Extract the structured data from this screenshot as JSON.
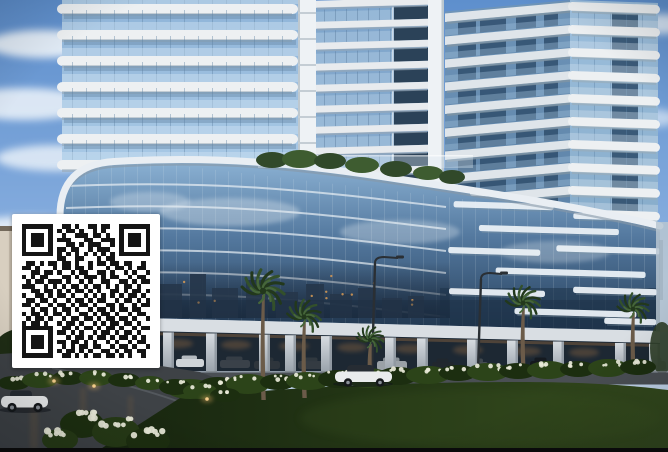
{
  "colors": {
    "sky_top": "#5e8fcd",
    "sky_mid": "#83abdd",
    "sky_low": "#c6d8ec",
    "cloud": "#eef4fa",
    "glass_light": "#a9c9e6",
    "glass_light2": "#8fb4d8",
    "glass_mid": "#7fa6cc",
    "glass_deep": "#2b4258",
    "slab_white": "#edf0f2",
    "slab_shade": "#dfe5ea",
    "slab_shadow": "#9aabb8",
    "pillar_strip": "#eef2f5",
    "podium_top": "#8cb2d4",
    "podium_mid": "#54799f",
    "podium_deep": "#27405c",
    "bar_white": "#eaf0f5",
    "parapet": "#e9eef3",
    "parapet_shadow": "#8798a6",
    "city": "#26364a",
    "warm": "#d79a55",
    "fascia": "#d9dee3",
    "pillar_top": "#d6dbe0",
    "pillar_bot": "#99a2ab",
    "opening": "#1d2833",
    "warm_glow": "#c08348",
    "road": "#3e4246",
    "road_front": "#4a4f54",
    "curb": "#7b8187",
    "lawn_dark": "#17250f",
    "lawn_mid": "#253816",
    "lawn_light": "#33491d",
    "shrub": "#2c4419",
    "shrub_dark": "#1c2e10",
    "flower": "#e9ead9",
    "frond": "#33502b",
    "frond_dark": "#22381c",
    "trunk": "#6b5b49",
    "lamp": "#2a2f34",
    "haze": "#b7c5d1",
    "beige": "#d8cfc0",
    "beige_dark": "#746a5c",
    "tree_dark": "#1f2d15",
    "car_white": "#e9ebec",
    "car_silver": "#a9b0b6",
    "window_dark": "#262c33",
    "qr_bg": "#ffffff",
    "qr_fg": "#141414",
    "bar": "#0a0a0b"
  },
  "qr": {
    "position": {
      "x": 12,
      "y": 214,
      "width": 148,
      "height": 154
    },
    "modules": 29,
    "matrix": [
      "11111110011010011011001111111",
      "10000010101101001010001000001",
      "10111010010011101101001011101",
      "10111010111000110011101011101",
      "10111010001101011100101011101",
      "10000010110110010111001000001",
      "11111110101010101010101111111",
      "00000000110011000101100000000",
      "01101011011010010110110110010",
      "11010001011011010001011010110",
      "00110110100101100110100101001",
      "10101100011010111010110010110",
      "01011011101001010011001101011",
      "11100101010110101101010110100",
      "00110110101011010100110101101",
      "10011010110100101010101011010",
      "01101101001011010110010110101",
      "11010010110101101001101001011",
      "00101101011010010110101101100",
      "10110101101001101011010010110",
      "01011010010110110101101101001",
      "10110100101101001010110110100",
      "11111110011010110101101001011",
      "10000010110101001011010110100",
      "10111010001011010110101101010",
      "10111010110110101001010010110",
      "10111010010101101100101101001",
      "10000010101101010011010110110",
      "11111110011010101101101010010"
    ]
  },
  "scene": {
    "clouds": [
      [
        42,
        44,
        55,
        14,
        0.9
      ],
      [
        24,
        104,
        70,
        16,
        0.85
      ],
      [
        56,
        158,
        60,
        13,
        0.8
      ],
      [
        30,
        233,
        75,
        17,
        0.85
      ],
      [
        52,
        298,
        55,
        13,
        0.75
      ],
      [
        26,
        344,
        65,
        14,
        0.7
      ],
      [
        658,
        24,
        42,
        10,
        0.8
      ],
      [
        650,
        118,
        30,
        9,
        0.6
      ],
      [
        620,
        60,
        26,
        8,
        0.5
      ]
    ],
    "left_tower": {
      "x": 57,
      "glass_x": 62,
      "width": 241,
      "floors": 6,
      "spacing": 26,
      "first_y": 4,
      "glass_h": 168
    },
    "mid_tower": {
      "x": 316,
      "width": 112,
      "floors": 9,
      "spacing": 21
    },
    "right_tower": {
      "corner_x": 572,
      "left_x": 445,
      "right_x": 658,
      "floors": 10,
      "spacing": 23
    },
    "podium_bars": [
      [
        452,
        204,
        100
      ],
      [
        572,
        212,
        80
      ],
      [
        478,
        227,
        140
      ],
      [
        448,
        250,
        92
      ],
      [
        556,
        245,
        104
      ],
      [
        496,
        269,
        150
      ],
      [
        450,
        291,
        96
      ],
      [
        574,
        286,
        84
      ],
      [
        516,
        309,
        122
      ],
      [
        606,
        316,
        52
      ],
      [
        468,
        192,
        56
      ],
      [
        560,
        196,
        44
      ]
    ],
    "floor_line_offsets": [
      22,
      44,
      66,
      88,
      110,
      132
    ],
    "city_buildings": [
      [
        96,
        278,
        26,
        40
      ],
      [
        130,
        270,
        20,
        48
      ],
      [
        158,
        284,
        24,
        34
      ],
      [
        190,
        274,
        16,
        44
      ],
      [
        212,
        288,
        26,
        30
      ],
      [
        246,
        280,
        22,
        38
      ],
      [
        276,
        292,
        22,
        26
      ],
      [
        306,
        284,
        18,
        34
      ],
      [
        330,
        294,
        22,
        24
      ],
      [
        358,
        288,
        18,
        30
      ],
      [
        382,
        298,
        20,
        20
      ],
      [
        408,
        296,
        16,
        22
      ]
    ],
    "garden_blobs": [
      [
        272,
        160,
        16,
        8
      ],
      [
        300,
        159,
        18,
        9
      ],
      [
        330,
        161,
        16,
        8
      ],
      [
        362,
        165,
        17,
        8
      ],
      [
        396,
        169,
        16,
        8
      ],
      [
        428,
        173,
        15,
        7
      ],
      [
        452,
        177,
        13,
        7
      ]
    ],
    "colonnade_pillars": [
      90,
      124,
      163,
      206,
      259,
      285,
      321,
      385,
      417,
      467,
      507,
      553,
      615,
      649
    ],
    "parked_cars": [
      [
        220,
        360,
        30,
        8,
        "#3a4149"
      ],
      [
        254,
        361,
        26,
        8,
        "#2e353c"
      ],
      [
        298,
        361,
        26,
        8,
        "#343b42"
      ],
      [
        377,
        361,
        30,
        9,
        "#9aa1a7"
      ],
      [
        432,
        362,
        22,
        8,
        "#21272e"
      ],
      [
        468,
        362,
        20,
        8,
        "#454c52"
      ],
      [
        530,
        361,
        22,
        8,
        "#14181d"
      ],
      [
        648,
        361,
        18,
        9,
        "#9299a0"
      ],
      [
        176,
        359,
        28,
        8,
        "#cfd4d8"
      ]
    ],
    "palms": [
      [
        263,
        291,
        400,
        1.25
      ],
      [
        304,
        317,
        398,
        1.0
      ],
      [
        370,
        340,
        384,
        0.8
      ],
      [
        523,
        303,
        374,
        1.0
      ],
      [
        633,
        309,
        374,
        0.92
      ]
    ],
    "lamps": [
      [
        372,
        371,
        263,
        26
      ],
      [
        478,
        369,
        279,
        24
      ]
    ],
    "shrub_band": [
      [
        190,
        389,
        24,
        10
      ],
      [
        218,
        386,
        20,
        9
      ],
      [
        248,
        384,
        22,
        10
      ],
      [
        278,
        382,
        18,
        8
      ],
      [
        308,
        381,
        22,
        9
      ],
      [
        338,
        379,
        20,
        9
      ],
      [
        368,
        378,
        22,
        10
      ],
      [
        398,
        376,
        20,
        9
      ],
      [
        428,
        375,
        22,
        9
      ],
      [
        458,
        373,
        19,
        8
      ],
      [
        488,
        372,
        21,
        9
      ],
      [
        518,
        371,
        19,
        8
      ],
      [
        548,
        370,
        21,
        9
      ],
      [
        578,
        369,
        18,
        8
      ],
      [
        608,
        368,
        20,
        9
      ],
      [
        638,
        367,
        18,
        8
      ]
    ],
    "island_blobs": [
      [
        14,
        383,
        16,
        7
      ],
      [
        40,
        380,
        18,
        8
      ],
      [
        68,
        378,
        16,
        7
      ],
      [
        96,
        378,
        17,
        8
      ],
      [
        124,
        380,
        16,
        7
      ],
      [
        150,
        383,
        15,
        7
      ],
      [
        175,
        387,
        16,
        8
      ],
      [
        200,
        391,
        17,
        8
      ],
      [
        225,
        395,
        15,
        7
      ]
    ],
    "island_lights": [
      [
        54,
        381
      ],
      [
        94,
        386
      ],
      [
        207,
        399
      ]
    ],
    "front_bushes": [
      [
        82,
        424,
        22,
        14
      ],
      [
        116,
        432,
        24,
        15
      ],
      [
        148,
        441,
        22,
        13
      ],
      [
        60,
        440,
        18,
        11
      ]
    ],
    "left_trees": [
      [
        20,
        355,
        28,
        26
      ],
      [
        55,
        345,
        24,
        22
      ],
      [
        8,
        372,
        20,
        18
      ]
    ]
  }
}
